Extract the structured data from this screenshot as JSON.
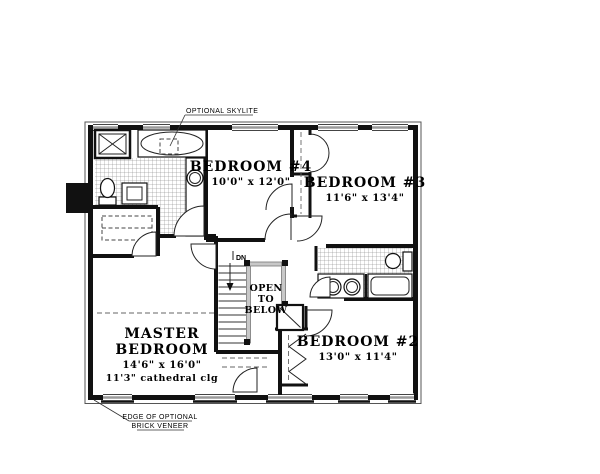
{
  "annotations": {
    "skylite": "OPTIONAL SKYLITE",
    "veneer1": "EDGE OF OPTIONAL",
    "veneer2": "BRICK VENEER",
    "dn": "DN"
  },
  "open_below": {
    "line1": "OPEN",
    "line2": "TO",
    "line3": "BELOW"
  },
  "rooms": {
    "master": {
      "name1": "MASTER",
      "name2": "BEDROOM",
      "dims": "14'6\" x 16'0\"",
      "ceiling": "11'3\" cathedral clg"
    },
    "bedroom4": {
      "name": "BEDROOM #4",
      "dims": "10'0\" x 12'0\""
    },
    "bedroom3": {
      "name": "BEDROOM #3",
      "dims": "11'6\" x 13'4\""
    },
    "bedroom2": {
      "name": "BEDROOM #2",
      "dims": "13'0\" x 11'4\""
    }
  },
  "colors": {
    "wall": "#111111",
    "window": "#9a9a9a",
    "railing": "#c8c8c8",
    "tile": "#777777",
    "background": "#ffffff"
  }
}
